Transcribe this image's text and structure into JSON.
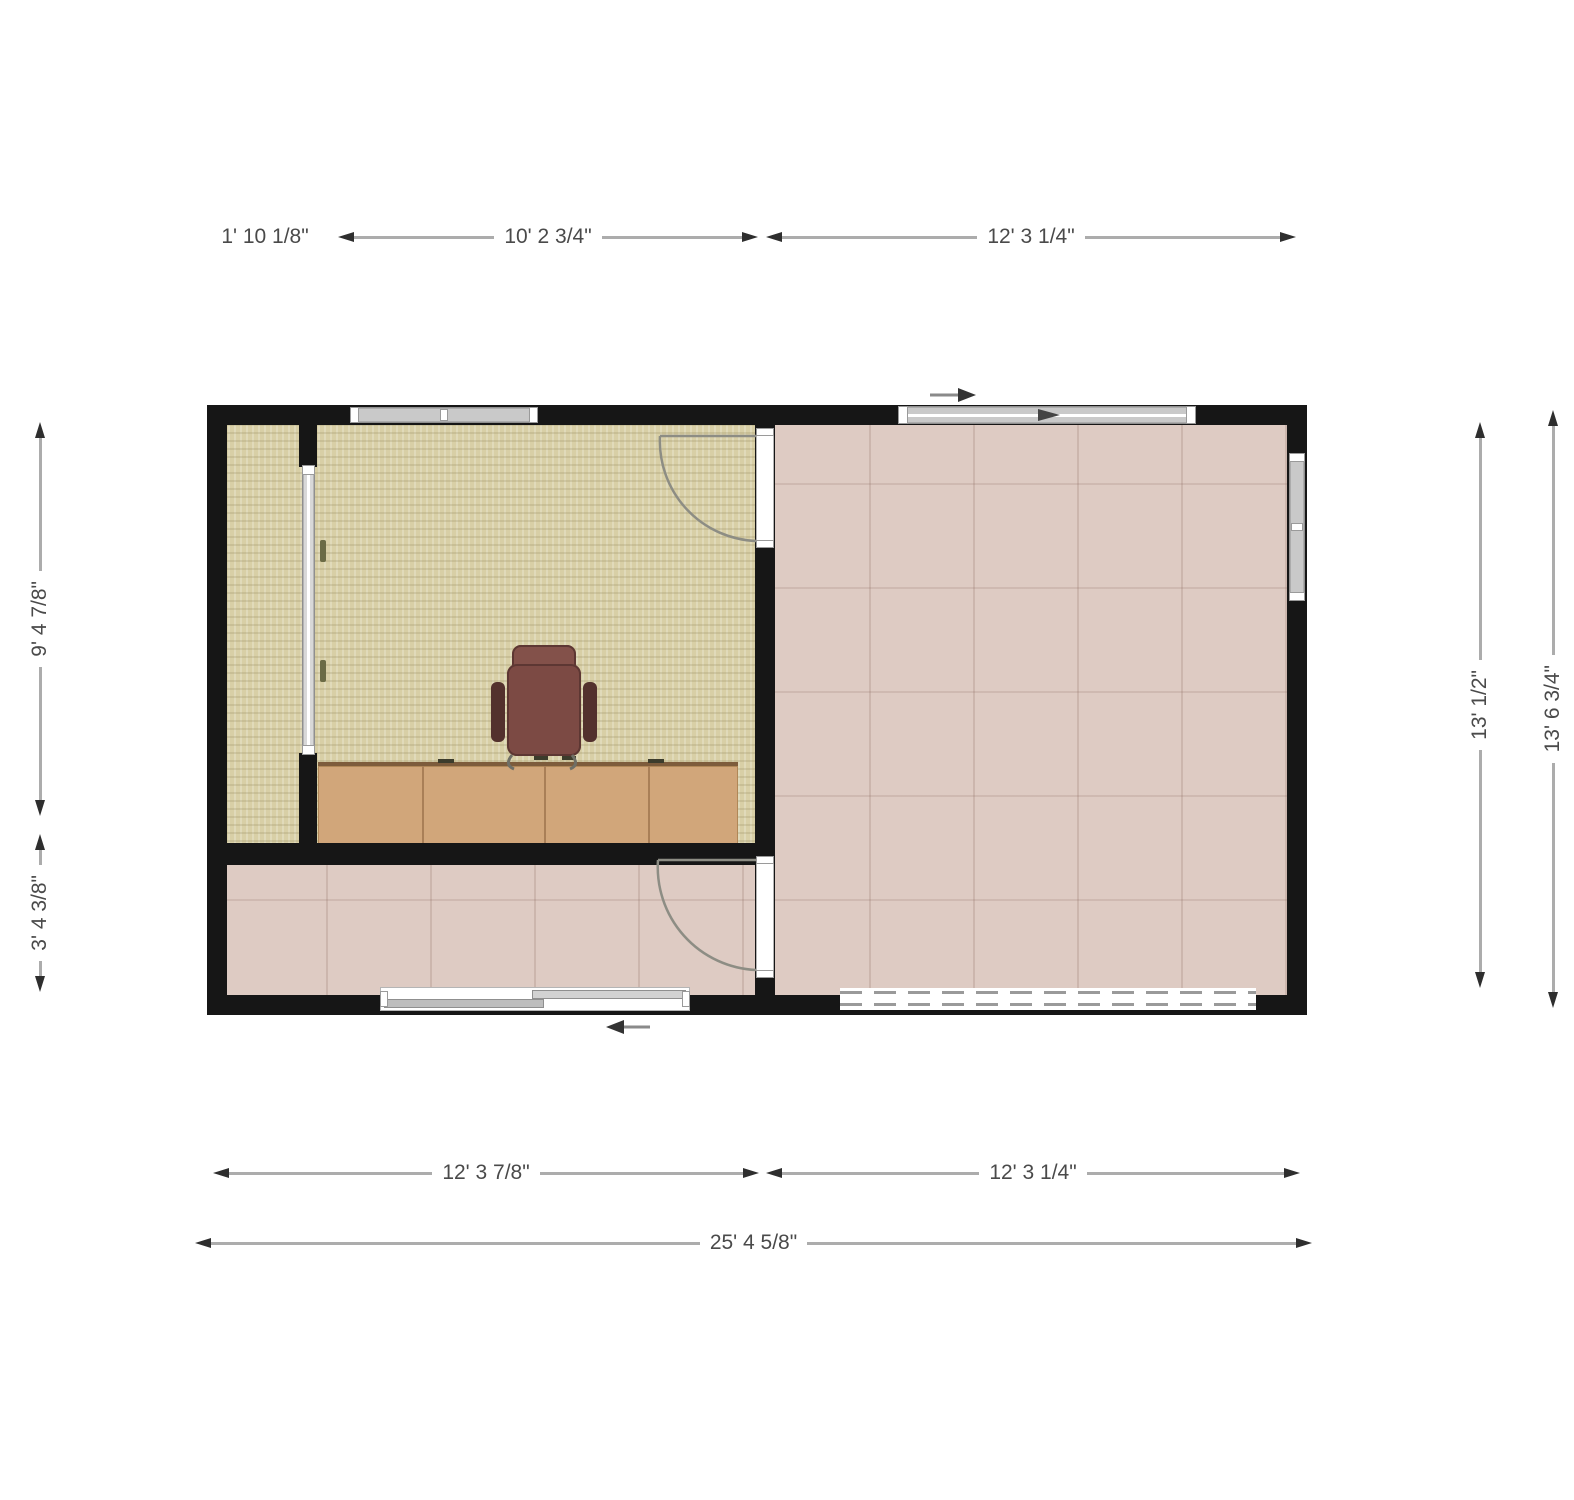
{
  "dimensions": {
    "top": [
      "1' 10 1/8\"",
      "10' 2 3/4\"",
      "12' 3 1/4\""
    ],
    "left": [
      "9' 4 7/8\"",
      "3' 4 3/8\""
    ],
    "right": [
      "13' 1/2\"",
      "13' 6 3/4\""
    ],
    "bottom": [
      "12' 3 7/8\"",
      "12' 3 1/4\"",
      "25' 4 5/8\""
    ]
  },
  "colors": {
    "background": "#ffffff",
    "wall": "#161616",
    "carpet_floor": "#d8cfa6",
    "tile_floor": "#decbc3",
    "desk": "#d1a67a",
    "chair": "#7c4a44",
    "window": "#c9c9c9",
    "dimension_line": "#acacac",
    "dimension_arrow": "#2e2e2e",
    "dimension_text": "#4a4a4a"
  }
}
